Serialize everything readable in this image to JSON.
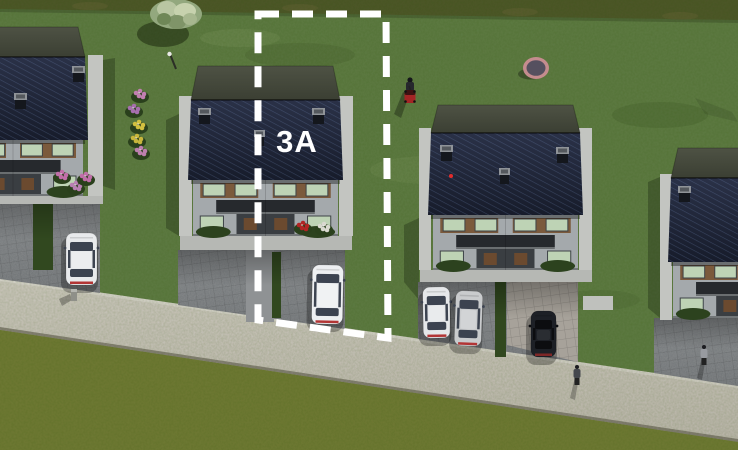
{
  "meta": {
    "description": "3D aerial rendering of a residential development site plan with building plot 3A outlined by a white dashed boundary",
    "image_px": {
      "w": 738,
      "h": 450
    }
  },
  "plot": {
    "label": "3A",
    "label_pos": {
      "x": 297,
      "y": 152
    },
    "boundary": {
      "points": "258,14 386,14 388,338 258,320",
      "color": "#ffffff",
      "stroke_width": 7,
      "dash": "21 13"
    }
  },
  "palette": {
    "grass": "#5d7b44",
    "grass_lower": "#6f7a35",
    "hedge_band": "#4c5629",
    "road_light": "#cfcbc2",
    "road_dark": "#b9b4aa",
    "pavers_light": "#7e8285",
    "pavers_dark": "#6b6f72",
    "gravel_parking": "#a7a29a",
    "concrete": "#c3c5c1",
    "apron": "#b6b8b4",
    "roof_navy_top": "#2a3147",
    "roof_navy_bottom": "#171c2b",
    "roof_ridge_top": "#4e5244",
    "roof_ridge_bottom": "#3b3f33",
    "facade": "#a4a9ac",
    "window_glass": "#bed3b5",
    "wood_trim": "#7b5a3c",
    "canopy": "#26292d",
    "hedge_strip": "#31481f",
    "trampoline_rim": "#c48c8e",
    "trampoline_mat": "#55505f",
    "mower_red": "#a42525"
  },
  "scene": {
    "hedge_top_poly": "0,0 738,0 738,20 0,9",
    "hedge_top_shadow": "0,9 738,20 738,23 0,12",
    "road_poly": "0,278 738,385 738,442 0,330",
    "road_top_curb": "0,278 738,385 738,388 0,281",
    "road_bottom_edge": "0,327 738,439 738,442 0,330",
    "lower_grass_poly": "0,330 738,442 738,450 0,450",
    "grass_patches": [
      [
        300,
        55,
        55,
        12,
        "rgba(25,40,12,0.10)"
      ],
      [
        660,
        115,
        48,
        13,
        "rgba(25,40,12,0.12)"
      ],
      [
        480,
        240,
        42,
        11,
        "rgba(25,40,12,0.08)"
      ],
      [
        240,
        38,
        40,
        9,
        "rgba(190,205,150,0.10)"
      ],
      [
        430,
        170,
        60,
        14,
        "rgba(190,205,150,0.08)"
      ],
      [
        600,
        300,
        40,
        10,
        "rgba(25,40,12,0.08)"
      ]
    ],
    "grass_streak_poly": "695,98 732,112 738,122 705,114",
    "houses": [
      {
        "id": 1,
        "roof": [
          -62,
          57,
          150,
          83
        ],
        "top_h": 30,
        "facade_h": 56,
        "strips": [
          [
            88,
            55,
            15,
            141
          ]
        ],
        "chimneys": [
          [
            72,
            66
          ],
          [
            14,
            93
          ]
        ],
        "apron": [
          0,
          196,
          103,
          8
        ],
        "driveway": "0,196 100,196 100,293 0,279",
        "hedge": [
          33,
          198,
          20,
          72
        ],
        "shadow": "103,60 115,58 115,190 103,186",
        "flowers": [
          {
            "c": "#c06ea8",
            "x": 62,
            "y": 176
          },
          {
            "c": "#b87fb2",
            "x": 76,
            "y": 187
          },
          {
            "c": "#c06ea8",
            "x": 86,
            "y": 178
          }
        ]
      },
      {
        "id": 2,
        "roof": [
          188,
          100,
          155,
          80
        ],
        "top_h": 34,
        "facade_h": 56,
        "strips": [
          [
            179,
            96,
            13,
            140
          ],
          [
            339,
            96,
            14,
            140
          ]
        ],
        "chimneys": [
          [
            198,
            108
          ],
          [
            312,
            108
          ]
        ],
        "center_chimney": [
          254,
          130
        ],
        "apron": [
          180,
          236,
          172,
          14
        ],
        "driveway": "178,250 345,250 345,329 178,305",
        "walk": [
          246,
          250,
          28,
          72
        ],
        "hedge": [
          272,
          252,
          9,
          66
        ],
        "shadow": "166,120 179,114 179,236 166,228",
        "flowers": [
          {
            "c": "#b32424",
            "x": 303,
            "y": 227
          },
          {
            "c": "#d9d9cf",
            "x": 324,
            "y": 228
          }
        ]
      },
      {
        "id": 3,
        "roof": [
          428,
          133,
          155,
          82
        ],
        "top_h": 28,
        "facade_h": 55,
        "strips": [
          [
            419,
            128,
            12,
            142
          ],
          [
            579,
            128,
            13,
            142
          ]
        ],
        "chimneys": [
          [
            440,
            145
          ],
          [
            556,
            147
          ]
        ],
        "center_chimney": [
          499,
          168
        ],
        "red_dot": [
          451,
          176
        ],
        "apron": [
          420,
          270,
          172,
          12
        ],
        "driveway": "418,282 578,282 578,362 418,339",
        "gravel": "507,282 578,282 578,362 507,345",
        "hedge": [
          495,
          273,
          11,
          84
        ],
        "walk_right": [
          583,
          296,
          30,
          14
        ],
        "shadow": "404,225 419,218 419,300 404,282"
      },
      {
        "id": 4,
        "roof": [
          668,
          178,
          154,
          84
        ],
        "top_h": 30,
        "facade_h": 56,
        "strips": [
          [
            660,
            174,
            12,
            146
          ]
        ],
        "chimneys": [
          [
            678,
            186
          ]
        ],
        "driveway": "654,318 738,318 738,386 654,373",
        "shadow": "648,182 660,177 660,318 648,308"
      }
    ],
    "cars": [
      {
        "id": "white-car-house1",
        "body": "#e8eaec",
        "x": 66,
        "y": 233,
        "w": 31,
        "h": 52,
        "rot": 0,
        "dark": false
      },
      {
        "id": "white-car-plot-3a",
        "body": "#edeff1",
        "x": 312,
        "y": 265,
        "w": 31,
        "h": 59,
        "rot": 1,
        "dark": false
      },
      {
        "id": "white-car-house3",
        "body": "#e5e7e9",
        "x": 423,
        "y": 287,
        "w": 27,
        "h": 51,
        "rot": -1,
        "dark": false
      },
      {
        "id": "silver-car-house3",
        "body": "#c9cbcd",
        "x": 455,
        "y": 291,
        "w": 27,
        "h": 55,
        "rot": 2,
        "dark": false
      },
      {
        "id": "black-car-house3",
        "body": "#1d2026",
        "x": 531,
        "y": 311,
        "w": 25,
        "h": 46,
        "rot": 0,
        "dark": true
      }
    ],
    "flower_bushes": [
      {
        "x": 140,
        "y": 95,
        "c": "#c27fb0"
      },
      {
        "x": 134,
        "y": 110,
        "c": "#a66fae"
      },
      {
        "x": 139,
        "y": 126,
        "c": "#d2c040"
      },
      {
        "x": 137,
        "y": 140,
        "c": "#c8b63c"
      },
      {
        "x": 141,
        "y": 152,
        "c": "#bd7fae"
      }
    ],
    "objects": {
      "tree": {
        "cx": 176,
        "cy": 15
      },
      "lamp": {
        "x1": 170,
        "y1": 54,
        "x2": 176,
        "y2": 69
      },
      "mower_person": {
        "x": 408,
        "y": 78
      },
      "trampoline": {
        "cx": 536,
        "cy": 68,
        "rx": 13,
        "ry": 11
      },
      "pedestrians": [
        {
          "x": 577,
          "y": 367,
          "style": "dark"
        },
        {
          "x": 704,
          "y": 347,
          "style": "light"
        }
      ],
      "post": {
        "x": 71,
        "y": 289
      }
    }
  }
}
